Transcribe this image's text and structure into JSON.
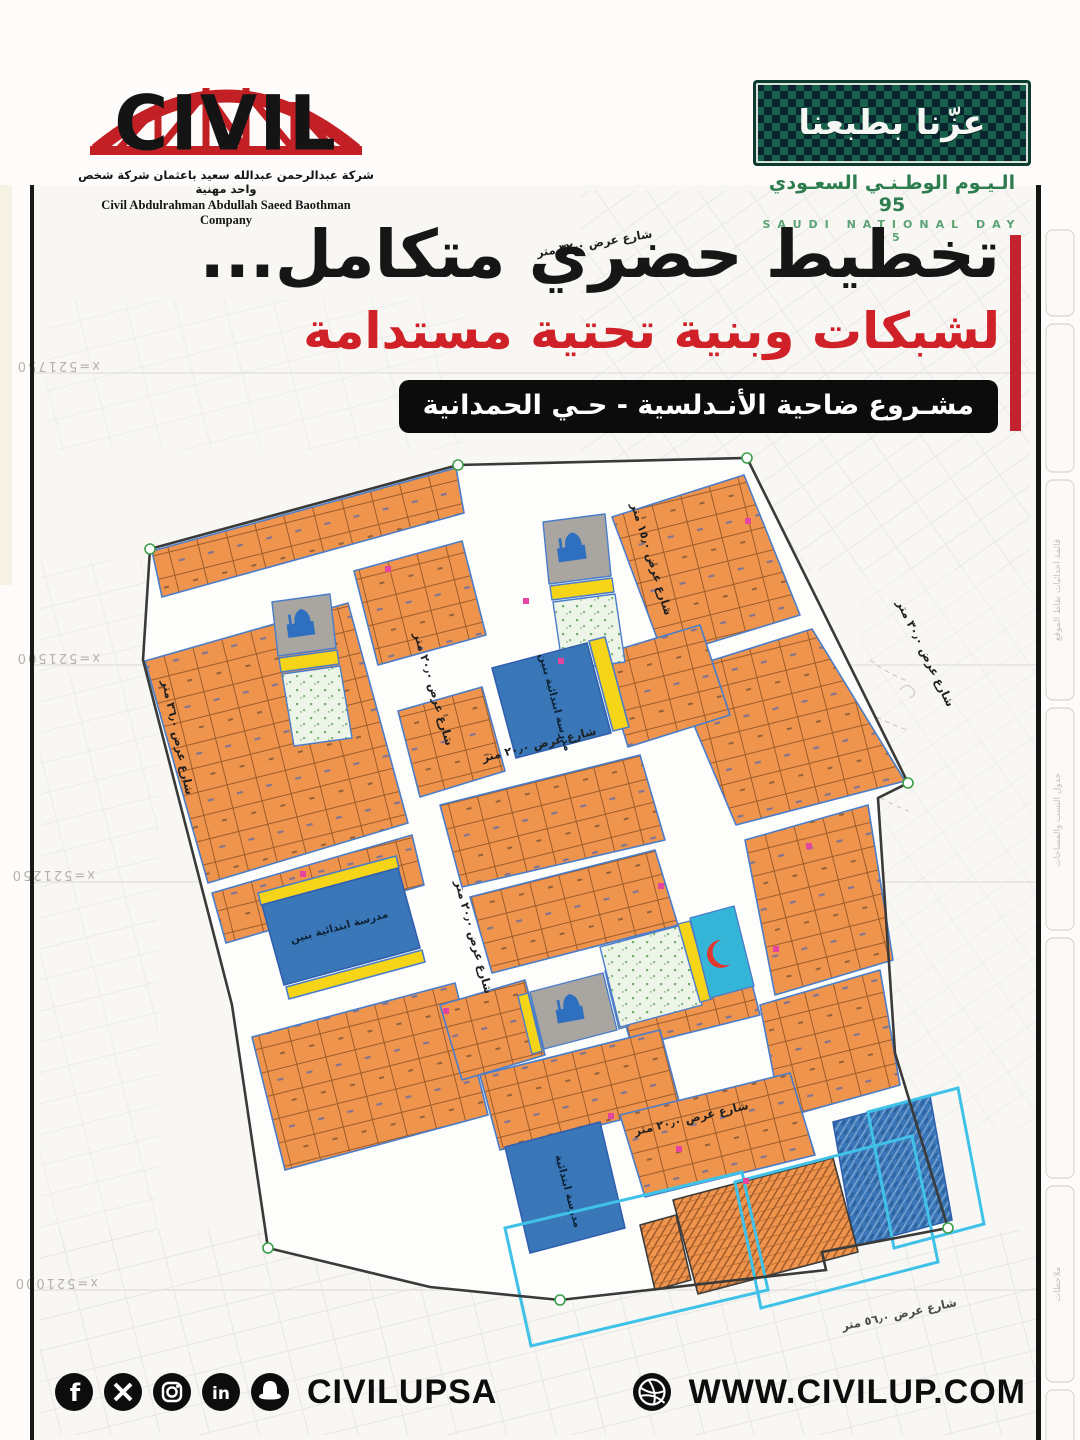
{
  "header": {
    "logo": {
      "brand": "CIVIL",
      "name_ar": "شركة عبدالرحمن عبدالله سعيد باعثمان شركة شخص واحد مهنية",
      "name_en": "Civil Abdulrahman Abdullah Saeed Baothman Company"
    },
    "national_day": {
      "slogan_ar": "عزّنا بطبعنا",
      "title_ar": "الـيـوم الوطـنـي السعـودي 95",
      "title_en": "SAUDI NATIONAL DAY 95"
    }
  },
  "headline": {
    "line1": "تخطيط حضري متكامل...",
    "line2": "لشبكات وبنية تحتية مستدامة",
    "project_banner": "مشـروع ضاحية الأنـدلسية - حـي الحمدانية"
  },
  "map": {
    "street_labels": [
      "شارع عرض ٣٢٫٠ متر",
      "شارع عرض ٢٠٫٠ متر",
      "شارع عرض ٢٠٫٠ متر",
      "شارع عرض ١٥٫٠ متر",
      "شارع عرض ٢٠٫٠ متر",
      "شارع عرض ٣٠٫٠ متر",
      "شارع عرض ٣٦٫٠ متر",
      "شارع عرض ٢٠٫٠ متر",
      "شارع عرض ٥٦٫٠ متر"
    ],
    "coordinate_labels": [
      "x=521750",
      "x=521500",
      "x=521250",
      "x=521000"
    ],
    "facility_labels": {
      "school_boys": "مدرسة ابتدائية بنين",
      "school_primary": "مدرسة ابتدائية"
    },
    "facility_icons": [
      "mosque-icon",
      "red-crescent-icon"
    ],
    "sidebar_panels": [
      "قائمة احداثيات نقاط الموقع",
      "جدول النسب والمساحات",
      "ملاحظات"
    ],
    "colors": {
      "plot_orange": "#ef944d",
      "school_blue": "#3a77b8",
      "health_cyan": "#35b6d9",
      "park_green": "#6aa45f",
      "commercial_yellow": "#f6d417",
      "outline_blue": "#4a7dc9",
      "boundary_cyan": "#3fc1e8",
      "tick_magenta": "#e544a0"
    }
  },
  "footer": {
    "handle": "CIVILUPSA",
    "website": "WWW.CIVILUP.COM",
    "social_icons": [
      "facebook-icon",
      "x-icon",
      "instagram-icon",
      "linkedin-icon",
      "snapchat-icon"
    ],
    "website_icon": "globe-icon"
  },
  "accent_colors": {
    "red": "#cf2127",
    "bar_red": "#c2232e",
    "black": "#111111",
    "nd_green": "#2e7d4f"
  }
}
